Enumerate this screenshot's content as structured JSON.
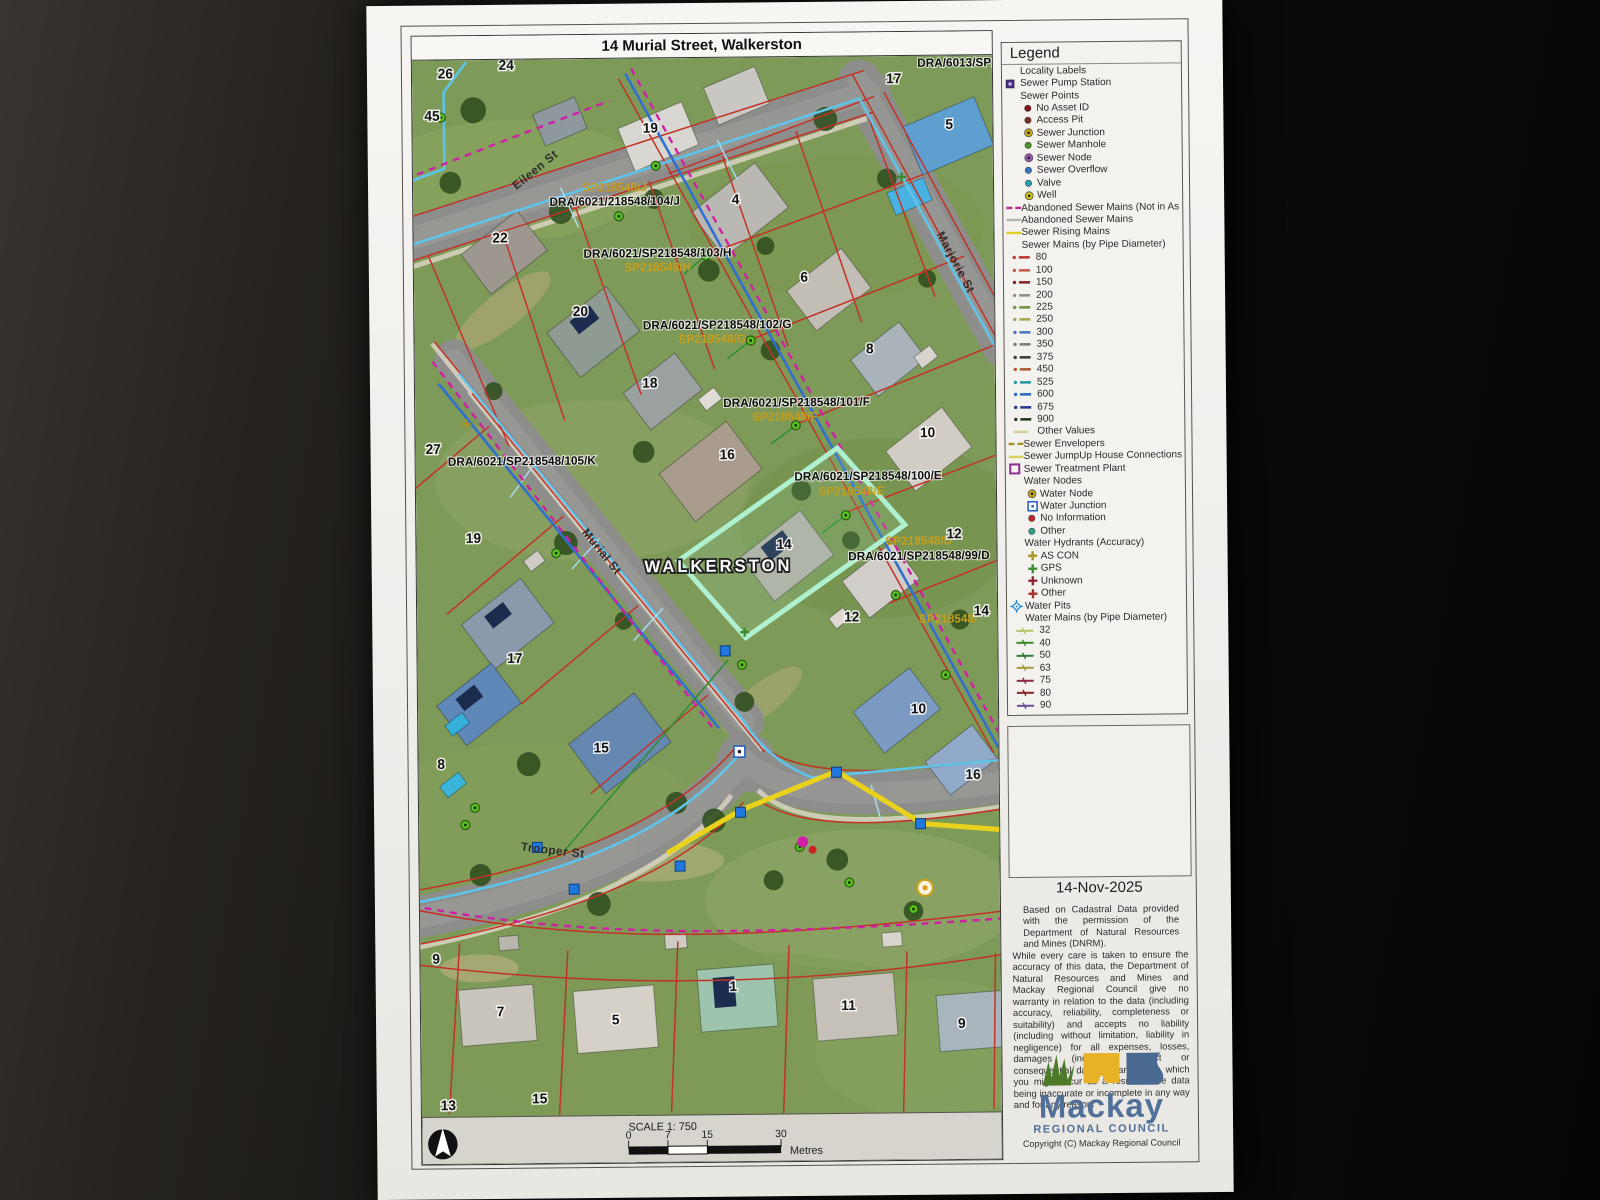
{
  "page": {
    "title": "14 Murial Street, Walkerston",
    "date": "14-Nov-2025",
    "disclaimer1": "Based on Cadastral Data provided with the permission of the Department of Natural Resources and Mines (DNRM).",
    "disclaimer2": "While every care is taken to ensure the accuracy of this data, the Department of Natural Resources and Mines and Mackay Regional Council give no warranty in relation to the data (including accuracy, reliability, completeness or suitability) and accepts no liability (including without limitation, liability in negligence) for all expenses, losses, damages (including indirect or consequential damage) and costs which you might incur as a result of the data being inaccurate or incomplete in any way and for any reason.",
    "copyright": "Copyright (C) Mackay Regional Council",
    "logo": {
      "name": "Mackay",
      "subtitle": "REGIONAL COUNCIL"
    },
    "scale": {
      "label": "SCALE   1: 750",
      "ticks": [
        "0",
        "7",
        "15",
        "30"
      ],
      "unit": "Metres"
    }
  },
  "legend": {
    "title": "Legend",
    "items": [
      {
        "label": "Locality Labels",
        "icon": "none",
        "color": "",
        "ind": 3
      },
      {
        "label": "Sewer Pump Station",
        "icon": "sq",
        "color": "#4a2a8a",
        "ind": 0
      },
      {
        "label": "Sewer Points",
        "icon": "none",
        "color": "",
        "ind": 3
      },
      {
        "label": "No Asset ID",
        "icon": "dot",
        "color": "#8a1020",
        "ind": 1
      },
      {
        "label": "Access Pit",
        "icon": "dot",
        "color": "#7a3020",
        "ind": 1
      },
      {
        "label": "Sewer Junction",
        "icon": "ring",
        "color": "#c8a818",
        "ind": 1
      },
      {
        "label": "Sewer Manhole",
        "icon": "dot",
        "color": "#4a9428",
        "ind": 1
      },
      {
        "label": "Sewer Node",
        "icon": "ring",
        "color": "#9858b0",
        "ind": 1
      },
      {
        "label": "Sewer Overflow",
        "icon": "dot",
        "color": "#3878c0",
        "ind": 1
      },
      {
        "label": "Valve",
        "icon": "dot",
        "color": "#28a0b0",
        "ind": 1
      },
      {
        "label": "Well",
        "icon": "ring",
        "color": "#ccc020",
        "ind": 1
      },
      {
        "label": "Abandoned Sewer Mains (Not in As",
        "icon": "dash2",
        "color": "#b82898",
        "ind": 0
      },
      {
        "label": "Abandoned Sewer Mains",
        "icon": "line",
        "color": "#b8b4ac",
        "ind": 0
      },
      {
        "label": "Sewer Rising Mains",
        "icon": "line",
        "color": "#e0d020",
        "ind": 0
      },
      {
        "label": "Sewer Mains (by Pipe Diameter)",
        "icon": "none",
        "color": "",
        "ind": 3
      },
      {
        "label": "80",
        "icon": "dashdot",
        "color": "#c03830",
        "ind": 2
      },
      {
        "label": "100",
        "icon": "dashdot",
        "color": "#c85848",
        "ind": 2
      },
      {
        "label": "150",
        "icon": "dashdot",
        "color": "#8c2424",
        "ind": 2
      },
      {
        "label": "200",
        "icon": "dashdot",
        "color": "#8e8e8e",
        "ind": 2
      },
      {
        "label": "225",
        "icon": "dashdot",
        "color": "#6f963c",
        "ind": 2
      },
      {
        "label": "250",
        "icon": "dashdot",
        "color": "#a6a64a",
        "ind": 2
      },
      {
        "label": "300",
        "icon": "dashdot",
        "color": "#4a78c4",
        "ind": 2
      },
      {
        "label": "350",
        "icon": "dashdot",
        "color": "#7a7a7a",
        "ind": 2
      },
      {
        "label": "375",
        "icon": "dashdot",
        "color": "#3c3c3c",
        "ind": 2
      },
      {
        "label": "450",
        "icon": "dashdot",
        "color": "#b05c34",
        "ind": 2
      },
      {
        "label": "525",
        "icon": "dashdot",
        "color": "#2a96a6",
        "ind": 2
      },
      {
        "label": "600",
        "icon": "dashdot",
        "color": "#2b68c0",
        "ind": 2
      },
      {
        "label": "675",
        "icon": "dashdot",
        "color": "#2b3a92",
        "ind": 2
      },
      {
        "label": "900",
        "icon": "dashdot",
        "color": "#24381f",
        "ind": 2
      },
      {
        "label": "Other Values",
        "icon": "line",
        "color": "#d6cf9a",
        "ind": 2
      },
      {
        "label": "Sewer Envelopers",
        "icon": "dash2",
        "color": "#a89424",
        "ind": 0
      },
      {
        "label": "Sewer JumpUp House Connections",
        "icon": "line",
        "color": "#d8d058",
        "ind": 0
      },
      {
        "label": "Sewer Treatment Plant",
        "icon": "sqo",
        "color": "#8c2d8f",
        "ind": 0
      },
      {
        "label": "Water Nodes",
        "icon": "none",
        "color": "",
        "ind": 3
      },
      {
        "label": "Water Node",
        "icon": "ring",
        "color": "#c8a818",
        "ind": 1
      },
      {
        "label": "Water Junction",
        "icon": "sqd",
        "color": "#2b5fc0",
        "ind": 1
      },
      {
        "label": "No Information",
        "icon": "dot",
        "color": "#c02424",
        "ind": 1
      },
      {
        "label": "Other",
        "icon": "dot",
        "color": "#28a08a",
        "ind": 1
      },
      {
        "label": "Water Hydrants (Accuracy)",
        "icon": "none",
        "color": "",
        "ind": 3
      },
      {
        "label": "AS CON",
        "icon": "cross",
        "color": "#a89424",
        "ind": 1
      },
      {
        "label": "GPS",
        "icon": "cross",
        "color": "#3c8c2c",
        "ind": 1
      },
      {
        "label": "Unknown",
        "icon": "cross",
        "color": "#8c2434",
        "ind": 1
      },
      {
        "label": "Other",
        "icon": "cross",
        "color": "#a03028",
        "ind": 1
      },
      {
        "label": "Water Pits",
        "icon": "diamond",
        "color": "#2b8fd6",
        "ind": 0
      },
      {
        "label": "Water Mains (by Pipe Diameter)",
        "icon": "none",
        "color": "",
        "ind": 3
      },
      {
        "label": "32",
        "icon": "dline",
        "color": "#b8c464",
        "ind": 2
      },
      {
        "label": "40",
        "icon": "dline",
        "color": "#3c8c2c",
        "ind": 2
      },
      {
        "label": "50",
        "icon": "dline",
        "color": "#2c7a34",
        "ind": 2
      },
      {
        "label": "63",
        "icon": "dline",
        "color": "#9c9c3c",
        "ind": 2
      },
      {
        "label": "75",
        "icon": "dline",
        "color": "#8c2c44",
        "ind": 2
      },
      {
        "label": "80",
        "icon": "dline",
        "color": "#8c2424",
        "ind": 2
      },
      {
        "label": "90",
        "icon": "dline",
        "color": "#6c4c94",
        "ind": 2
      }
    ]
  },
  "map": {
    "locality": {
      "label": "WALKERSTON",
      "x": 307,
      "y": 512
    },
    "streets": [
      {
        "label": "Eileen St",
        "x": 105,
        "y": 130,
        "rot": -38
      },
      {
        "label": "Marjorie St",
        "x": 532,
        "y": 178,
        "rot": 62
      },
      {
        "label": "Murial St",
        "x": 168,
        "y": 472,
        "rot": 51
      },
      {
        "label": "Trooper St",
        "x": 103,
        "y": 788,
        "rot": 7
      }
    ],
    "plans": [
      {
        "text": "DRA/6013/SP208541/72/R",
        "x": 586,
        "y": 11,
        "c": "k",
        "anchor": "end"
      },
      {
        "text": "SP218548/J",
        "x": 205,
        "y": 132,
        "c": "y"
      },
      {
        "text": "DRA/6021/218548/104/J",
        "x": 205,
        "y": 146,
        "c": "k"
      },
      {
        "text": "DRA/6021/SP218548/103/H",
        "x": 248,
        "y": 198,
        "c": "k"
      },
      {
        "text": "SP218548/H",
        "x": 248,
        "y": 212,
        "c": "y"
      },
      {
        "text": "DRA/6021/SP218548/102/G",
        "x": 308,
        "y": 270,
        "c": "k"
      },
      {
        "text": "SP218548/G",
        "x": 303,
        "y": 284,
        "c": "y"
      },
      {
        "text": "DRA/6021/SP218548/101/F",
        "x": 388,
        "y": 348,
        "c": "k"
      },
      {
        "text": "SP218548/F",
        "x": 376,
        "y": 362,
        "c": "y"
      },
      {
        "text": "DRA/6021/SP218548/100/E",
        "x": 460,
        "y": 422,
        "c": "k"
      },
      {
        "text": "SP218548/E",
        "x": 443,
        "y": 437,
        "c": "y"
      },
      {
        "text": "SP218548/D",
        "x": 511,
        "y": 487,
        "c": "y"
      },
      {
        "text": "DRA/6021/SP218548/99/D",
        "x": 511,
        "y": 502,
        "c": "k"
      },
      {
        "text": "SP218548/",
        "x": 540,
        "y": 565,
        "c": "y"
      },
      {
        "text": "DRA/6021/SP218548/105/K",
        "x": 108,
        "y": 404,
        "c": "k"
      }
    ],
    "lots": [
      {
        "n": "26",
        "x": 34,
        "y": 18
      },
      {
        "n": "24",
        "x": 96,
        "y": 10
      },
      {
        "n": "45",
        "x": 20,
        "y": 60
      },
      {
        "n": "19",
        "x": 242,
        "y": 74
      },
      {
        "n": "17",
        "x": 490,
        "y": 27
      },
      {
        "n": "5",
        "x": 546,
        "y": 73
      },
      {
        "n": "22",
        "x": 88,
        "y": 182
      },
      {
        "n": "4",
        "x": 328,
        "y": 146
      },
      {
        "n": "20",
        "x": 169,
        "y": 256
      },
      {
        "n": "6",
        "x": 397,
        "y": 224
      },
      {
        "n": "8",
        "x": 463,
        "y": 296
      },
      {
        "n": "18",
        "x": 239,
        "y": 328
      },
      {
        "n": "10",
        "x": 521,
        "y": 380
      },
      {
        "n": "16",
        "x": 317,
        "y": 400
      },
      {
        "n": "19",
        "x": 58,
        "y": 481
      },
      {
        "n": "14",
        "x": 374,
        "y": 490
      },
      {
        "n": "12",
        "x": 547,
        "y": 481
      },
      {
        "n": "17",
        "x": 99,
        "y": 601
      },
      {
        "n": "12",
        "x": 442,
        "y": 563
      },
      {
        "n": "14",
        "x": 574,
        "y": 558
      },
      {
        "n": "10",
        "x": 509,
        "y": 655
      },
      {
        "n": "8",
        "x": 23,
        "y": 706
      },
      {
        "n": "15",
        "x": 186,
        "y": 691
      },
      {
        "n": "16",
        "x": 564,
        "y": 721
      },
      {
        "n": "9",
        "x": 16,
        "y": 900
      },
      {
        "n": "7",
        "x": 81,
        "y": 953
      },
      {
        "n": "5",
        "x": 198,
        "y": 962
      },
      {
        "n": "1",
        "x": 318,
        "y": 930
      },
      {
        "n": "11",
        "x": 435,
        "y": 950
      },
      {
        "n": "9",
        "x": 550,
        "y": 969
      },
      {
        "n": "13",
        "x": 27,
        "y": 1046
      },
      {
        "n": "15",
        "x": 120,
        "y": 1040
      },
      {
        "n": "27",
        "x": 18,
        "y": 392
      }
    ]
  }
}
